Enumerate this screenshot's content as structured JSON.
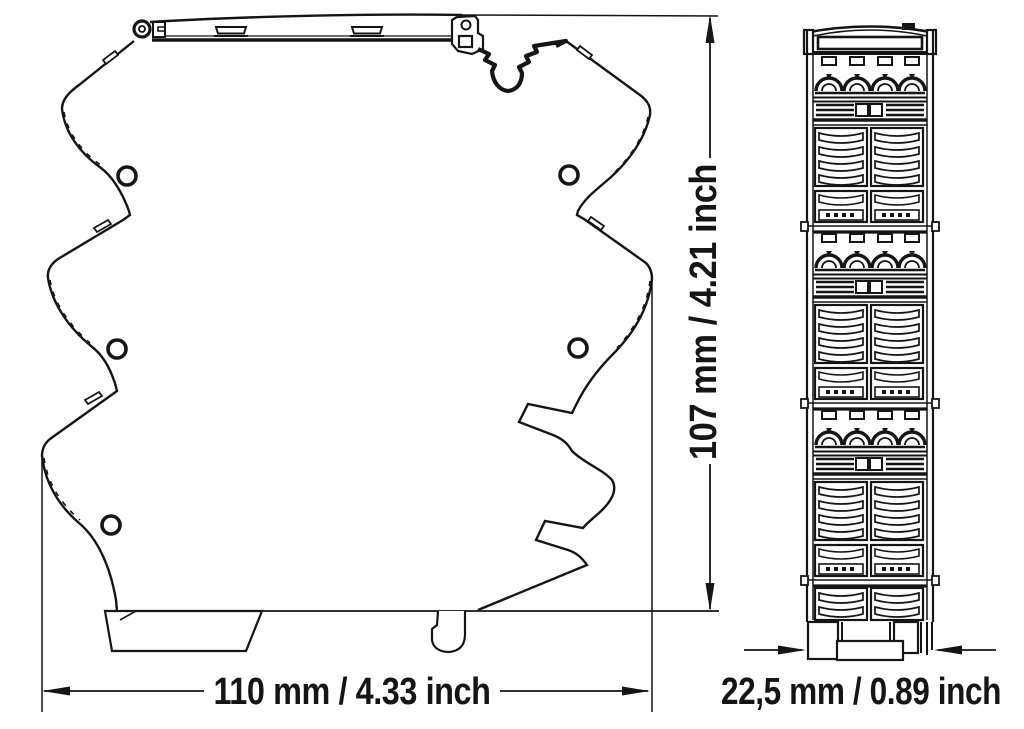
{
  "figure": {
    "kind": "technical-dimension-drawing",
    "dimensions": {
      "height_label": "107 mm / 4.21 inch",
      "width_label": "110 mm / 4.33 inch",
      "depth_label": "22,5 mm / 0.89 inch"
    },
    "colors": {
      "ink": "#151515",
      "background": "#ffffff"
    }
  }
}
